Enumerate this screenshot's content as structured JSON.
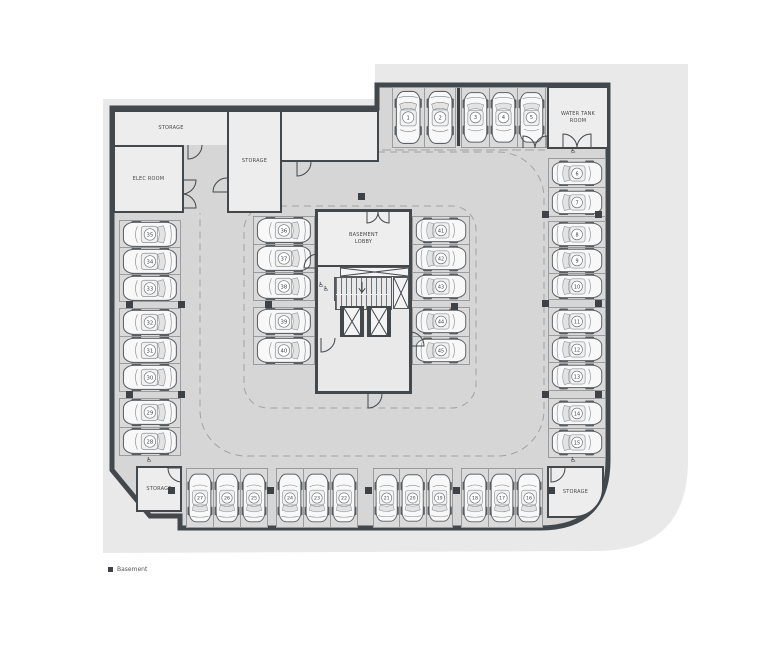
{
  "legend": {
    "label": "Basement"
  },
  "rooms": {
    "top_storage": "STORAGE",
    "elec": "ELEC ROOM",
    "mid_storage": "STORAGE",
    "water_tank_l1": "WATER TANK",
    "water_tank_l2": "ROOM",
    "lobby_l1": "BASEMENT",
    "lobby_l2": "LOBBY",
    "storage_bottom_left": "STORAGE",
    "storage_bottom_right": "STORAGE"
  },
  "icons": {
    "accessible": "♿"
  },
  "parking": {
    "top_a": [
      1,
      2
    ],
    "top_b": [
      3,
      4,
      5
    ],
    "right_a": [
      6,
      7
    ],
    "right_b": [
      8,
      9,
      10
    ],
    "right_c": [
      11,
      12,
      13
    ],
    "right_d": [
      14,
      15
    ],
    "bottom_a": [
      27,
      26,
      25
    ],
    "bottom_b": [
      24,
      23,
      22
    ],
    "bottom_c": [
      21,
      20,
      19
    ],
    "bottom_d": [
      18,
      17,
      16
    ],
    "left_a": [
      35,
      34,
      33
    ],
    "left_b": [
      32,
      31,
      30
    ],
    "left_c": [
      29,
      28
    ],
    "mid_left_a": [
      36,
      37,
      38
    ],
    "mid_left_b": [
      39,
      40
    ],
    "mid_right_a": [
      41,
      42,
      43
    ],
    "mid_right_b": [
      44,
      45
    ]
  }
}
